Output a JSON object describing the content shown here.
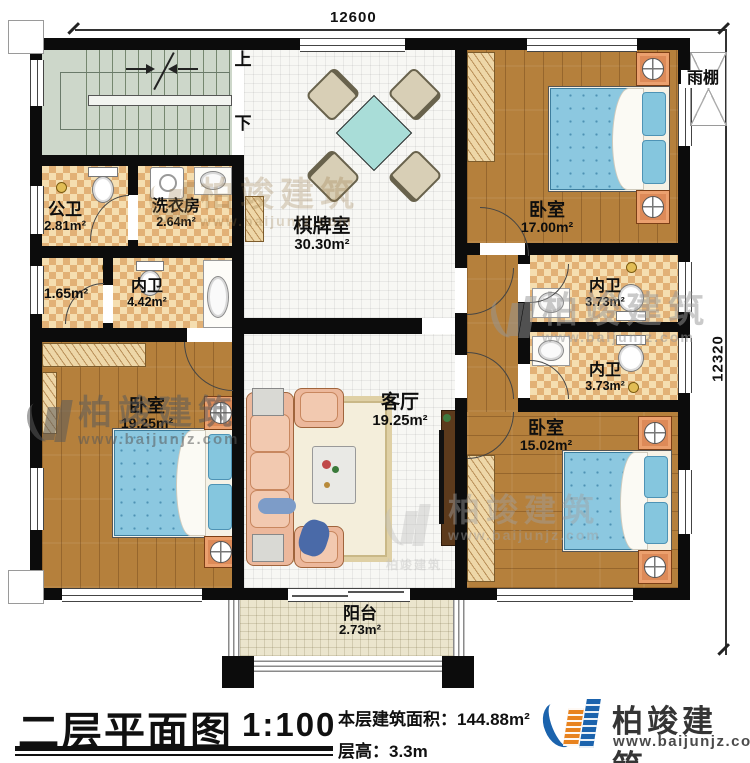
{
  "plan": {
    "dim_top": "12600",
    "dim_right": "12320",
    "stairs": {
      "up": "上",
      "down": "下"
    },
    "canopy": "雨棚",
    "rooms": [
      {
        "name": "公卫",
        "area": "2.81m²"
      },
      {
        "name": "洗衣房",
        "area": "2.64m²"
      },
      {
        "name": "",
        "area": "1.65m²"
      },
      {
        "name": "内卫",
        "area": "4.42m²"
      },
      {
        "name": "棋牌室",
        "area": "30.30m²"
      },
      {
        "name": "卧室",
        "area": "17.00m²"
      },
      {
        "name": "内卫",
        "area": "3.73m²"
      },
      {
        "name": "内卫",
        "area": "3.73m²"
      },
      {
        "name": "卧室",
        "area": "19.25m²"
      },
      {
        "name": "客厅",
        "area": "19.25m²"
      },
      {
        "name": "卧室",
        "area": "15.02m²"
      },
      {
        "name": "阳台",
        "area": "2.73m²"
      }
    ],
    "watermark": {
      "brand": "柏竣建筑",
      "url": "www.baijunjz.com"
    }
  },
  "titlebar": {
    "title": "二层平面图",
    "scale": "1:100",
    "area_label": "本层建筑面积：144.88m²",
    "height_label": "层高：3.3m",
    "brand": "柏竣建筑",
    "brand_url": "www.baijunjz.com"
  },
  "colors": {
    "wall": "#0c0c0c",
    "wood": "#b5803c",
    "tile_dark": "#e2b176",
    "bed": "#8cc8e0",
    "table": "#a9ddd8",
    "stairs": "#cdd7ca",
    "logo_blue": "#1b63ad",
    "logo_orange": "#e8831f"
  }
}
